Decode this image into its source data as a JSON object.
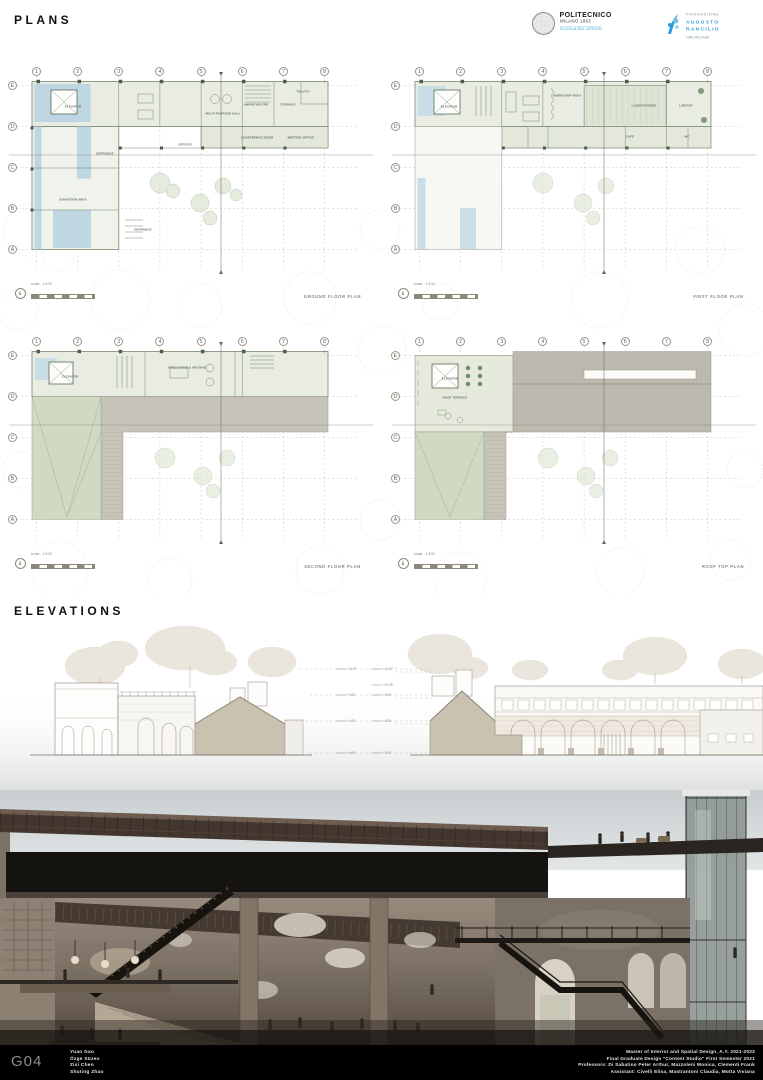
{
  "header": {
    "title": "PLANS",
    "polimi": {
      "name": "POLITECNICO",
      "place": "MILANO 1863",
      "school": "SCUOLA DEL DESIGN"
    },
    "far": {
      "l1": "FONDAZIONE",
      "l2": "AUGUSTO",
      "l3": "RANCILIO",
      "sub": "Villa Arconati"
    }
  },
  "plans": {
    "grid_columns": [
      "1",
      "2",
      "3",
      "4",
      "5",
      "6",
      "7",
      "8"
    ],
    "grid_rows": [
      "E",
      "D",
      "C",
      "B",
      "A"
    ],
    "scale_label": "scale - 1/100",
    "items": [
      {
        "title": "GROUND FLOOR PLAN",
        "rooms": [
          "ELEVATOR",
          "EXHIBITION AREA",
          "ENTRANCE",
          "OFFICES",
          "MULTI-PURPOSE HALL",
          "AMPHITHEATRE",
          "STORAGE",
          "TOILETS",
          "CONFERENCE ROOM",
          "MEETING OFFICE",
          "ENTRANCE"
        ]
      },
      {
        "title": "FIRST FLOOR PLAN",
        "rooms": [
          "ELEVATOR",
          "WORKSHOP AREA",
          "LABORATORIES",
          "LIBRARY",
          "CAFE",
          "WC"
        ]
      },
      {
        "title": "SECOND FLOOR PLAN",
        "rooms": [
          "ELEVATOR",
          "VIDEO ROOM & ARCHIVE"
        ]
      },
      {
        "title": "ROOF TOP PLAN",
        "rooms": [
          "ELEVATOR",
          "ROOF TERRACE"
        ]
      }
    ]
  },
  "elevations": {
    "title": "ELEVATIONS",
    "levels": [
      "+12.87",
      "+10.35",
      "+9.05",
      "+4.25",
      "+0.00"
    ]
  },
  "footer": {
    "group_code": "G04",
    "authors": [
      "Yuan Gao",
      "Özge Süzen",
      "Zixi Chen",
      "Shuting Zhao"
    ],
    "credits": [
      "Master of Interior and Spatial Design, A.Y. 2021-2022",
      "Final Graduate Design \"Contest Studio\" First Semester 2021",
      "Professors: Di Sabatino Peter Arthur, Mazzoleni Monica, Clementi Frank",
      "Assistant: Civelli Elisa, Mastrantoni Claudia, Motta Viviana"
    ]
  },
  "colors": {
    "accent_blue": "#2e9bd6",
    "plan_green": "#e9ece3",
    "water_blue": "#b7d2e2",
    "roof_gray": "#c6c3b9",
    "elevation_tan": "#c9c2b0",
    "footer_bg": "#000000"
  }
}
